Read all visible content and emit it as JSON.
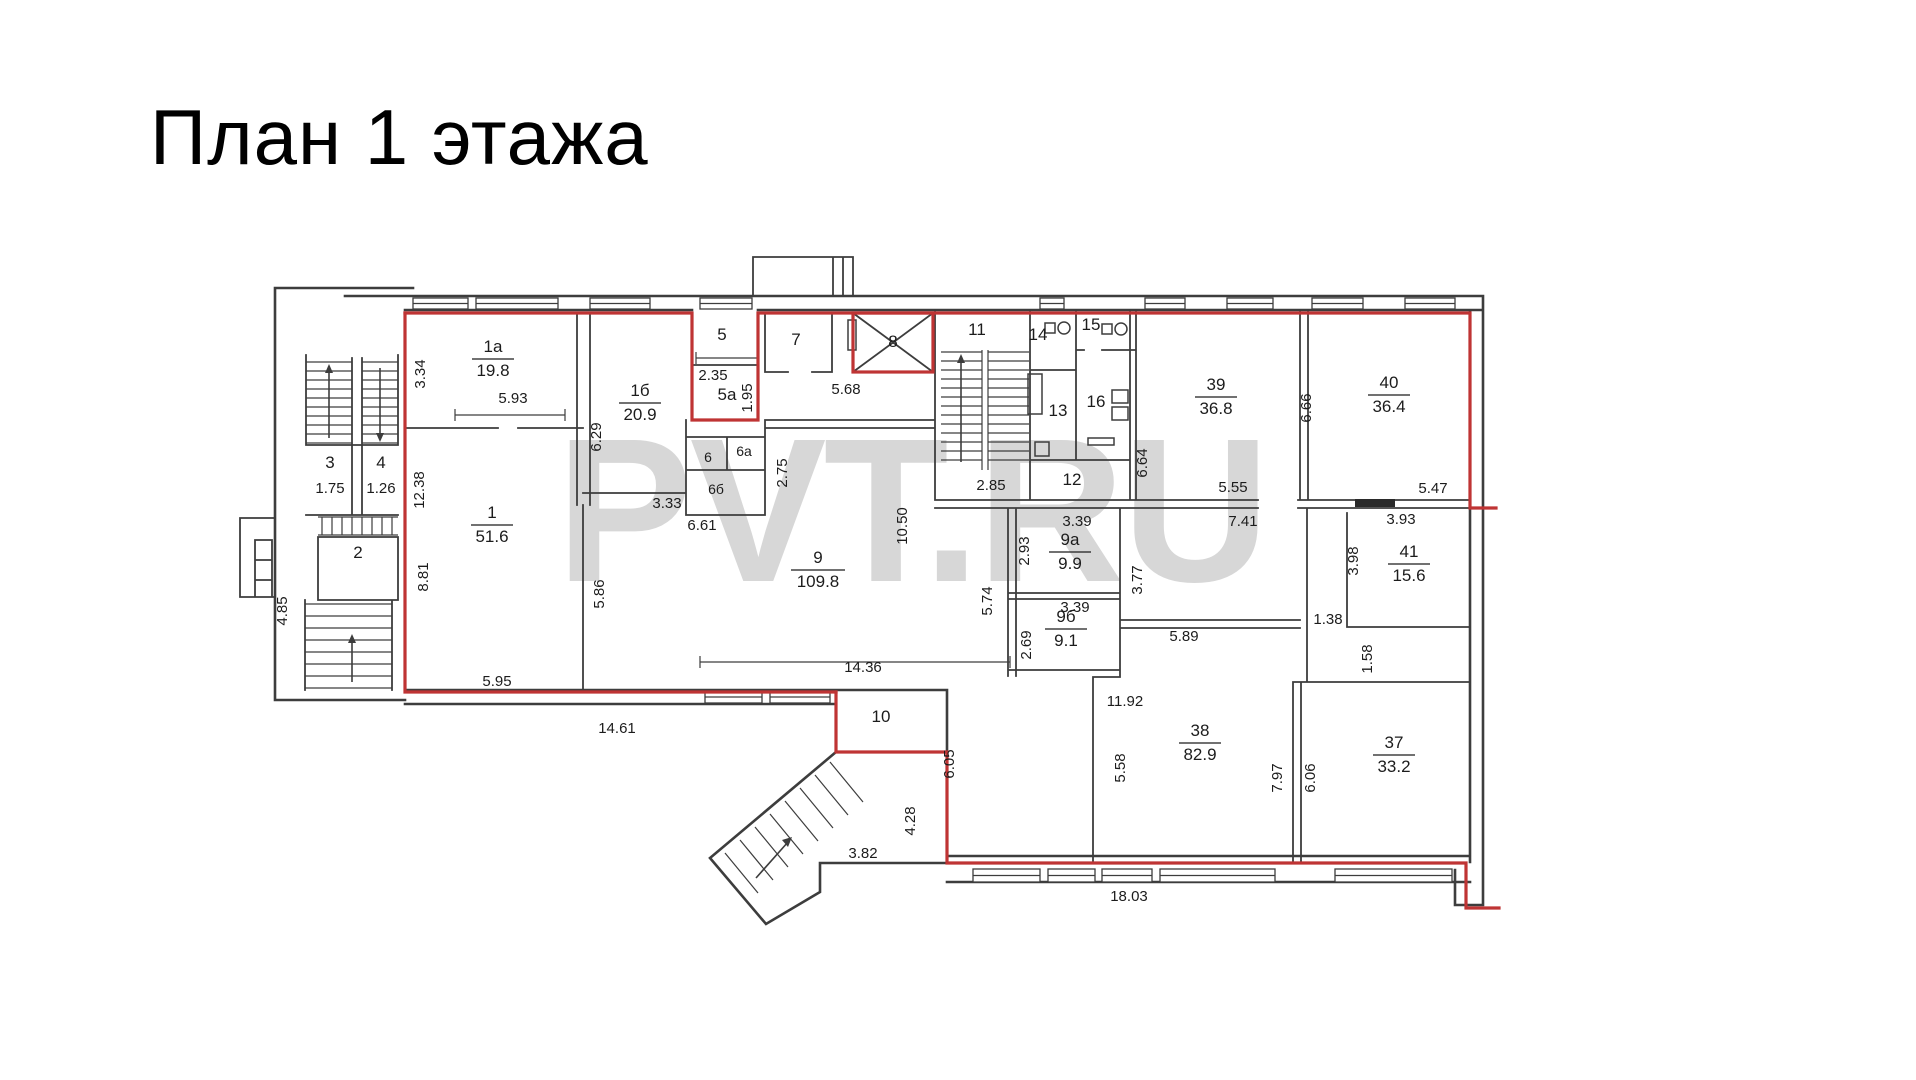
{
  "title": "План 1 этажа",
  "watermark": "PVT.RU",
  "colors": {
    "outline_red": "#bf3434",
    "wall": "#3d3d3d",
    "watermark": "#d7d7d7"
  },
  "rooms": [
    {
      "num": "1а",
      "area": "19.8",
      "style": "frac",
      "x": 493,
      "y": 352
    },
    {
      "num": "1б",
      "area": "20.9",
      "style": "frac",
      "x": 640,
      "y": 396
    },
    {
      "num": "1",
      "area": "51.6",
      "style": "frac",
      "x": 492,
      "y": 518
    },
    {
      "num": "2",
      "area": null,
      "style": "plain",
      "x": 358,
      "y": 558
    },
    {
      "num": "3",
      "area": "1.75",
      "style": "stack",
      "x": 330,
      "y": 468
    },
    {
      "num": "4",
      "area": "1.26",
      "style": "stack",
      "x": 381,
      "y": 468
    },
    {
      "num": "5",
      "area": null,
      "style": "plain",
      "x": 722,
      "y": 340
    },
    {
      "num": "5а",
      "area": null,
      "style": "plain",
      "x": 727,
      "y": 400
    },
    {
      "num": "6",
      "area": null,
      "style": "small",
      "x": 708,
      "y": 462
    },
    {
      "num": "6а",
      "area": null,
      "style": "small",
      "x": 744,
      "y": 456
    },
    {
      "num": "6б",
      "area": null,
      "style": "small",
      "x": 716,
      "y": 494
    },
    {
      "num": "7",
      "area": null,
      "style": "plain",
      "x": 796,
      "y": 345
    },
    {
      "num": "8",
      "area": null,
      "style": "plain",
      "x": 893,
      "y": 347
    },
    {
      "num": "9",
      "area": "109.8",
      "style": "frac",
      "x": 818,
      "y": 563
    },
    {
      "num": "9а",
      "area": "9.9",
      "style": "frac",
      "x": 1070,
      "y": 545
    },
    {
      "num": "9б",
      "area": "9.1",
      "style": "frac",
      "x": 1066,
      "y": 622
    },
    {
      "num": "10",
      "area": null,
      "style": "plain",
      "x": 881,
      "y": 722
    },
    {
      "num": "11",
      "area": null,
      "style": "plain",
      "x": 977,
      "y": 335
    },
    {
      "num": "12",
      "area": null,
      "style": "plain",
      "x": 1072,
      "y": 485
    },
    {
      "num": "13",
      "area": null,
      "style": "plain",
      "x": 1058,
      "y": 416
    },
    {
      "num": "14",
      "area": null,
      "style": "plain",
      "x": 1038,
      "y": 340
    },
    {
      "num": "15",
      "area": null,
      "style": "plain",
      "x": 1091,
      "y": 330
    },
    {
      "num": "16",
      "area": null,
      "style": "plain",
      "x": 1096,
      "y": 407
    },
    {
      "num": "37",
      "area": "33.2",
      "style": "frac",
      "x": 1394,
      "y": 748
    },
    {
      "num": "38",
      "area": "82.9",
      "style": "frac",
      "x": 1200,
      "y": 736
    },
    {
      "num": "39",
      "area": "36.8",
      "style": "frac",
      "x": 1216,
      "y": 390
    },
    {
      "num": "40",
      "area": "36.4",
      "style": "frac",
      "x": 1389,
      "y": 388
    },
    {
      "num": "41",
      "area": "15.6",
      "style": "frac",
      "x": 1409,
      "y": 557
    }
  ],
  "dimensions": [
    {
      "text": "3.34",
      "x": 425,
      "y": 374,
      "rot": 1
    },
    {
      "text": "5.93",
      "x": 513,
      "y": 403,
      "rot": 0
    },
    {
      "text": "12.38",
      "x": 424,
      "y": 490,
      "rot": 1
    },
    {
      "text": "8.81",
      "x": 428,
      "y": 577,
      "rot": 1
    },
    {
      "text": "4.85",
      "x": 287,
      "y": 611,
      "rot": 1
    },
    {
      "text": "5.95",
      "x": 497,
      "y": 686,
      "rot": 0
    },
    {
      "text": "14.61",
      "x": 617,
      "y": 733,
      "rot": 0
    },
    {
      "text": "6.29",
      "x": 601,
      "y": 437,
      "rot": 1
    },
    {
      "text": "3.33",
      "x": 667,
      "y": 508,
      "rot": 0
    },
    {
      "text": "6.61",
      "x": 702,
      "y": 530,
      "rot": 0
    },
    {
      "text": "2.35",
      "x": 713,
      "y": 380,
      "rot": 0
    },
    {
      "text": "1.95",
      "x": 752,
      "y": 398,
      "rot": 1
    },
    {
      "text": "2.75",
      "x": 787,
      "y": 473,
      "rot": 1
    },
    {
      "text": "5.68",
      "x": 846,
      "y": 394,
      "rot": 0
    },
    {
      "text": "10.50",
      "x": 907,
      "y": 526,
      "rot": 1
    },
    {
      "text": "14.36",
      "x": 863,
      "y": 672,
      "rot": 0
    },
    {
      "text": "5.86",
      "x": 604,
      "y": 594,
      "rot": 1
    },
    {
      "text": "2.85",
      "x": 991,
      "y": 490,
      "rot": 0
    },
    {
      "text": "5.74",
      "x": 992,
      "y": 601,
      "rot": 1
    },
    {
      "text": "2.93",
      "x": 1029,
      "y": 551,
      "rot": 1
    },
    {
      "text": "3.39",
      "x": 1077,
      "y": 526,
      "rot": 0
    },
    {
      "text": "3.39",
      "x": 1075,
      "y": 612,
      "rot": 0
    },
    {
      "text": "2.69",
      "x": 1031,
      "y": 645,
      "rot": 1
    },
    {
      "text": "3.77",
      "x": 1142,
      "y": 580,
      "rot": 1
    },
    {
      "text": "6.64",
      "x": 1147,
      "y": 463,
      "rot": 1
    },
    {
      "text": "5.55",
      "x": 1233,
      "y": 492,
      "rot": 0
    },
    {
      "text": "7.41",
      "x": 1243,
      "y": 526,
      "rot": 0
    },
    {
      "text": "6.66",
      "x": 1311,
      "y": 408,
      "rot": 1
    },
    {
      "text": "5.47",
      "x": 1433,
      "y": 493,
      "rot": 0
    },
    {
      "text": "3.93",
      "x": 1401,
      "y": 524,
      "rot": 0
    },
    {
      "text": "3.98",
      "x": 1358,
      "y": 561,
      "rot": 1
    },
    {
      "text": "1.38",
      "x": 1328,
      "y": 624,
      "rot": 0
    },
    {
      "text": "1.58",
      "x": 1372,
      "y": 659,
      "rot": 1
    },
    {
      "text": "5.89",
      "x": 1184,
      "y": 641,
      "rot": 0
    },
    {
      "text": "11.92",
      "x": 1125,
      "y": 706,
      "rot": 0
    },
    {
      "text": "5.58",
      "x": 1125,
      "y": 768,
      "rot": 1
    },
    {
      "text": "7.97",
      "x": 1282,
      "y": 778,
      "rot": 1
    },
    {
      "text": "6.06",
      "x": 1315,
      "y": 778,
      "rot": 1
    },
    {
      "text": "18.03",
      "x": 1129,
      "y": 901,
      "rot": 0
    },
    {
      "text": "6.05",
      "x": 954,
      "y": 764,
      "rot": 1
    },
    {
      "text": "4.28",
      "x": 915,
      "y": 821,
      "rot": 1
    },
    {
      "text": "3.82",
      "x": 863,
      "y": 858,
      "rot": 0
    }
  ],
  "icons": [
    {
      "name": "toilet-icon",
      "x": 1062,
      "y": 328
    },
    {
      "name": "toilet-icon",
      "x": 1119,
      "y": 329
    }
  ]
}
